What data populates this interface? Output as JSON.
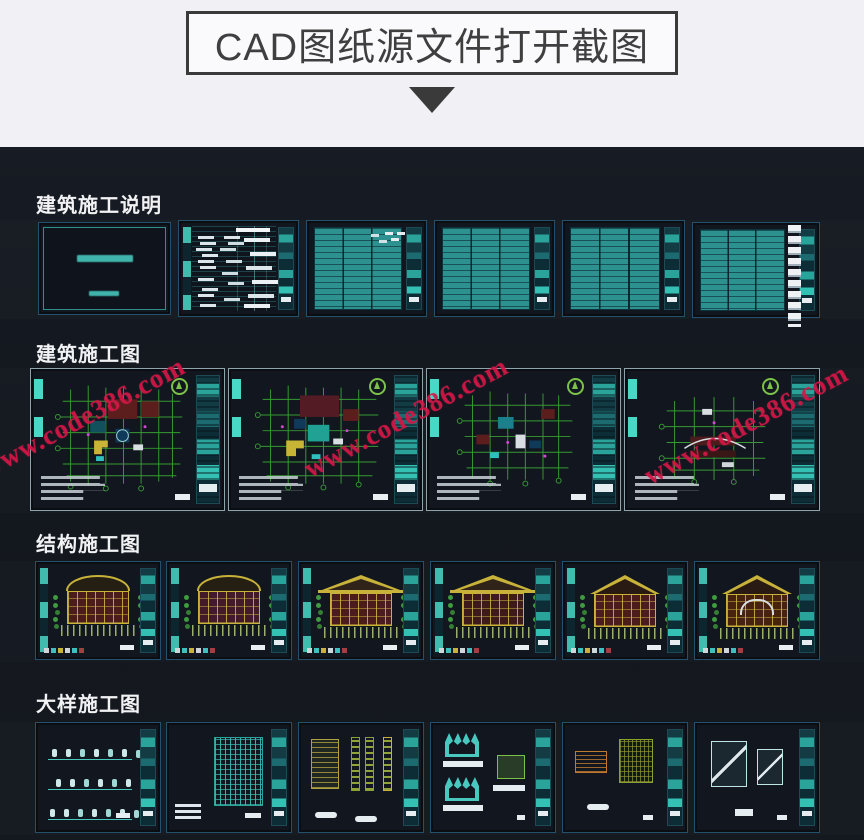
{
  "header": {
    "title": "CAD图纸源文件打开截图"
  },
  "sections": {
    "notes": {
      "label": "建筑施工说明"
    },
    "arch": {
      "label": "建筑施工图"
    },
    "struct": {
      "label": "结构施工图"
    },
    "detail": {
      "label": "大样施工图"
    }
  },
  "watermark": {
    "text": "www.code386.com",
    "color": "#d61647"
  },
  "colors": {
    "header_bg": "#f1f0f4",
    "title_border": "#3a3a3a",
    "panel_bg": "#14181f",
    "sheet_teal": "#2d918f",
    "accent_teal": "#49d8c6",
    "grid_green": "#3aa135",
    "fill_dark_red": "#5c1d1d",
    "fill_yellow": "#c9b535",
    "watermark_red": "#d61647"
  }
}
